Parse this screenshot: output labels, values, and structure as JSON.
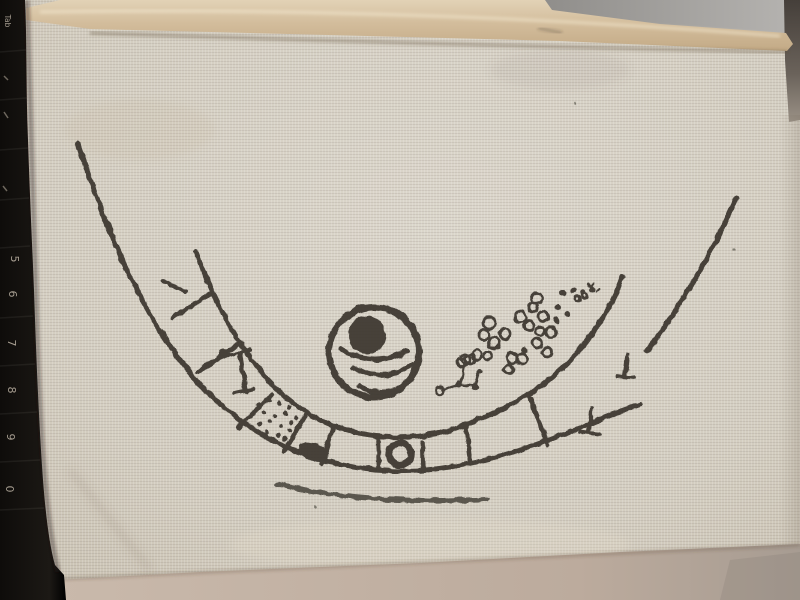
{
  "scene": {
    "subject": "hand-drawn cell-like diagram stitched on woven cream fabric",
    "surroundings": "black keyboard edge on the left, grey desk surface above and below the fabric"
  },
  "keyboard": {
    "visible_keys": [
      "Tab",
      "5",
      "6",
      "7",
      "8",
      "9",
      "0"
    ]
  },
  "drawing": {
    "ink_color": "#3a362f",
    "elements": [
      "outer-membrane-arc-right",
      "outer-membrane-arc-bottom",
      "segmented-band-outer-arc",
      "segmented-band-inner-arc",
      "band-rungs",
      "nail-pin-shape",
      "granule-dot-cluster",
      "dark-oval-organelle",
      "ring-organelle",
      "nucleus-ring",
      "nucleolus-dot",
      "smile-arcs",
      "bead-twig",
      "vesicle-circle-cluster",
      "tick-marks"
    ]
  },
  "colors": {
    "fabric": "#d6d0c4",
    "fabric_shadow": "#c7bfae",
    "hem_fold": "#d2bd9d",
    "ink": "#3a362f",
    "keyboard_black": "#16130f",
    "desk_below": "#bfb0a2",
    "grey_surface_top": "#a5a3a0",
    "dark_strip_top_right": "#4a443f"
  }
}
